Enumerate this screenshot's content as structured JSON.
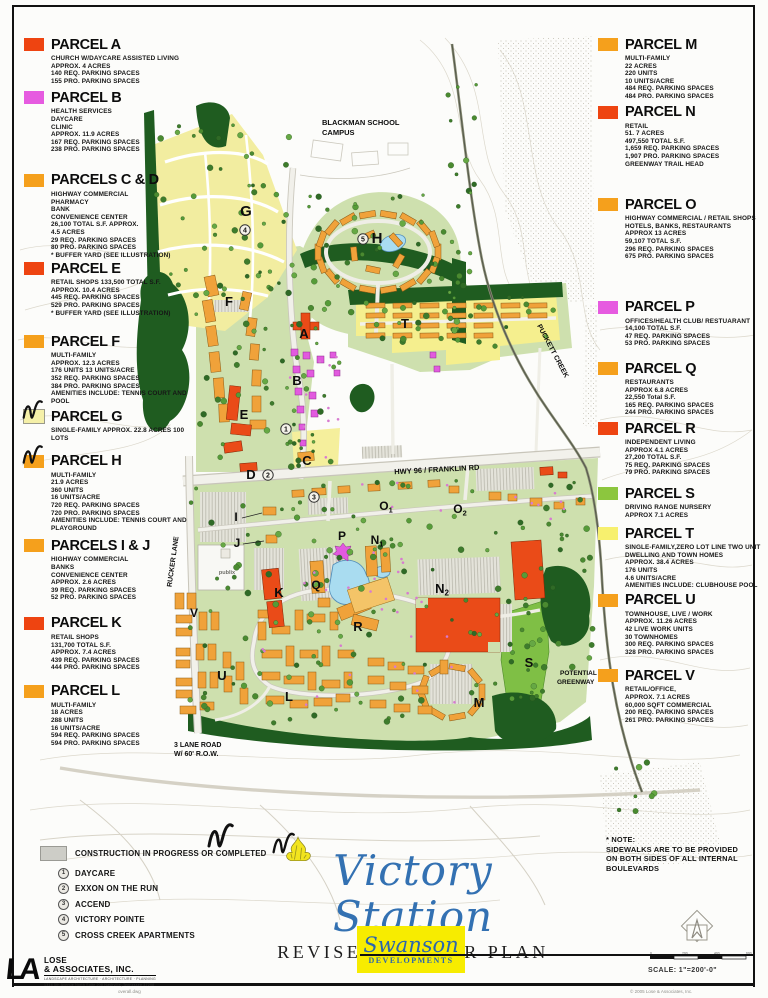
{
  "left_legend": [
    {
      "title": "PARCEL A",
      "swatch": "#EE4411",
      "gap": 4,
      "lines": [
        "CHURCH W/DAYCARE ASSISTED LIVING",
        "APPROX. 4 ACRES",
        "140 REQ. PARKING SPACES",
        "155 PRO. PARKING SPACES"
      ]
    },
    {
      "title": "PARCEL B",
      "swatch": "#E65BE0",
      "gap": 18,
      "lines": [
        "HEALTH SERVICES",
        "DAYCARE",
        "CLINIC",
        "APPROX. 11.9 ACRES",
        "167 REQ. PARKING SPACES",
        "238 PRO. PARKING SPACES"
      ]
    },
    {
      "title": "PARCELS C & D",
      "swatch": "#F5A01C",
      "gap": 1,
      "lines": [
        "HIGHWAY COMMERCIAL",
        "PHARMACY",
        "BANK",
        "CONVENIENCE CENTER",
        "26,100 TOTAL S.F. APPROX.",
        "4.5 ACRES",
        "29 REQ. PARKING SPACES",
        "80 PRO. PARKING SPACES",
        "* BUFFER YARD (SEE ILLUSTRATION)"
      ]
    },
    {
      "title": "PARCEL E",
      "swatch": "#EE4411",
      "gap": 16,
      "lines": [
        "RETAIL SHOPS 133,500 TOTAL S.F.",
        "APPROX. 10.4 ACRES",
        "445 REQ. PARKING SPACES",
        "529 PRO. PARKING SPACES",
        "* BUFFER YARD (SEE ILLUSTRATION)"
      ]
    },
    {
      "title": "PARCEL F",
      "swatch": "#F5A01C",
      "gap": 3,
      "lines": [
        "MULTI-FAMILY",
        "APPROX. 12.3 ACRES",
        "176 UNITS 13 UNITS/ACRE",
        "352 REQ. PARKING SPACES",
        "384 PRO. PARKING SPACES",
        "AMENITIES INCLUDE: TENNIS COURT AND",
        "POOL"
      ]
    },
    {
      "title": "PARCEL G",
      "swatch": "#F5F0A8",
      "check": true,
      "border": true,
      "gap": 10,
      "lines": [
        "SINGLE-FAMILY APPROX. 22.8 ACRES 100",
        "LOTS"
      ]
    },
    {
      "title": "PARCEL H",
      "swatch": "#F5A01C",
      "check": true,
      "gap": 5,
      "lines": [
        "MULTI-FAMILY",
        "21.9 ACRES",
        "360 UNITS",
        "16 UNITS/ACRE",
        "720 REQ. PARKING SPACES",
        "720 PRO. PARKING SPACES",
        "AMENITIES INCLUDE: TENNIS COURT AND",
        "PLAYGROUND"
      ]
    },
    {
      "title": "PARCELS I & J",
      "swatch": "#F5A01C",
      "gap": 13,
      "lines": [
        "HIGHWAY COMMERCIAL",
        "BANKS",
        "CONVENIENCE CENTER",
        "APPROX. 2.6 ACRES",
        "39 REQ. PARKING SPACES",
        "52 PRO. PARKING SPACES"
      ]
    },
    {
      "title": "PARCEL K",
      "swatch": "#EE4411",
      "gap": 11,
      "lines": [
        "RETAIL SHOPS",
        "131,700 TOTAL S.F.",
        "APPROX. 7.4 ACRES",
        "439 REQ. PARKING SPACES",
        "444 PRO. PARKING SPACES"
      ]
    },
    {
      "title": "PARCEL L",
      "swatch": "#F5A01C",
      "gap": 0,
      "lines": [
        "MULTI-FAMILY",
        "18 ACRES",
        "288 UNITS",
        "16 UNITS/ACRE",
        "594 REQ. PARKING SPACES",
        "594 PRO. PARKING SPACES"
      ]
    }
  ],
  "right_legend": [
    {
      "title": "PARCEL M",
      "swatch": "#F5A01C",
      "gap": 3,
      "lines": [
        "MULTI-FAMILY",
        "22 ACRES",
        "220 UNITS",
        "10 UNITS/ACRE",
        "484 REQ. PARKING SPACES",
        "484 PRO. PARKING SPACES"
      ]
    },
    {
      "title": "PARCEL N",
      "swatch": "#EE4411",
      "gap": 28,
      "lines": [
        "RETAIL",
        "51. 7 ACRES",
        "497,550 TOTAL S.F.",
        "1,659  REQ. PARKING SPACES",
        "1,907 PRO. PARKING SPACES",
        "GREENWAY TRAIL HEAD"
      ]
    },
    {
      "title": "PARCEL O",
      "swatch": "#F5A01C",
      "gap": 38,
      "lines": [
        "HIGHWAY COMMERCIAL / RETAIL SHOPS",
        "HOTELS, BANKS, RESTAURANTS",
        "APPROX 13 ACRES",
        "59,107 TOTAL S.F.",
        "296 REQ. PARKING SPACES",
        "675 PRO. PARKING SPACES"
      ]
    },
    {
      "title": "PARCEL P",
      "swatch": "#E65BE0",
      "gap": 12,
      "lines": [
        "OFFICES/HEALTH CLUB/ RESTUARANT",
        "14,100 TOTAL S.F.",
        "47 REQ. PARKING SPACES",
        "53 PRO. PARKING SPACES"
      ]
    },
    {
      "title": "PARCEL Q",
      "swatch": "#F5A01C",
      "gap": 3,
      "lines": [
        "RESTAURANTS",
        "APPROX 6.8 ACRES",
        "22,550 Total S.F.",
        "165 REQ. PARKING SPACES",
        "244 PRO. PARKING SPACES"
      ]
    },
    {
      "title": "PARCEL R",
      "swatch": "#EE4411",
      "gap": 8,
      "lines": [
        "INDEPENDENT LIVING",
        "APPROX 4.1 ACRES",
        "27,200 TOTAL S.F.",
        "75 REQ. PARKING SPACES",
        "79 PRO. PARKING SPACES"
      ]
    },
    {
      "title": "PARCEL S",
      "swatch": "#8CC63E",
      "gap": 6,
      "lines": [
        "DRIVING RANGE  NURSERY",
        "APPROX 7.1 ACRES"
      ]
    },
    {
      "title": "PARCEL T",
      "swatch": "#F7F06E",
      "gap": 2,
      "lines": [
        "SINGLE-FAMILY,ZERO LOT LINE  TWO UNIT",
        "DWELLING AND TOWN HOMES",
        "APPROX. 38.4 ACRES",
        "176 UNITS",
        "4.6 UNITS/ACRE",
        "AMENITIES INCLUDE:  CLUBHOUSE  POOL"
      ]
    },
    {
      "title": "PARCEL U",
      "swatch": "#F5A01C",
      "gap": 11,
      "lines": [
        "TOWNHOUSE, LIVE / WORK",
        "APPROX. 11.26 ACRES",
        "42 LIVE WORK UNITS",
        "30 TOWNHOMES",
        "300 REQ. PARKING SPACES",
        "328 PRO. PARKING SPACES"
      ]
    },
    {
      "title": "PARCEL V",
      "swatch": "#F5A01C",
      "gap": 0,
      "lines": [
        "RETAIL/OFFICE,",
        "APPROX. 7.1 ACRES",
        "60,000 SQFT COMMERCIAL",
        "200 REQ. PARKING SPACES",
        "261 PRO. PARKING SPACES"
      ]
    }
  ],
  "map": {
    "labels": [
      {
        "t": "BLACKMAN SCHOOL",
        "x": 322,
        "y": 125,
        "s": 7.5,
        "a": "start"
      },
      {
        "t": "CAMPUS",
        "x": 322,
        "y": 135,
        "s": 7.5,
        "a": "start"
      },
      {
        "t": "PUCKETT CREEK",
        "x": 551,
        "y": 352,
        "s": 7,
        "r": 62
      },
      {
        "t": "HWY 96 / FRANKLIN RD",
        "x": 437,
        "y": 472,
        "s": 7.5,
        "r": -3
      },
      {
        "t": "RUCKER LANE",
        "x": 175,
        "y": 562,
        "s": 7,
        "r": -82
      },
      {
        "t": "POTENTIAL",
        "x": 560,
        "y": 675,
        "s": 6.5,
        "a": "start"
      },
      {
        "t": "GREENWAY",
        "x": 557,
        "y": 684,
        "s": 6.5,
        "a": "start"
      },
      {
        "t": "3 LANE ROAD",
        "x": 174,
        "y": 747,
        "s": 7,
        "a": "start"
      },
      {
        "t": "W/ 60' R.O.W.",
        "x": 174,
        "y": 756,
        "s": 7,
        "a": "start"
      },
      {
        "t": "publix",
        "x": 227,
        "y": 574,
        "s": 5.5,
        "c": "#6e6e68"
      },
      {
        "t": "G",
        "x": 246,
        "y": 216,
        "s": 15
      },
      {
        "t": "H",
        "x": 377,
        "y": 243,
        "s": 15
      },
      {
        "t": "F",
        "x": 229,
        "y": 306,
        "s": 13
      },
      {
        "t": "A",
        "x": 304,
        "y": 338,
        "s": 13
      },
      {
        "t": "B",
        "x": 297,
        "y": 385,
        "s": 13
      },
      {
        "t": "E",
        "x": 244,
        "y": 419,
        "s": 13
      },
      {
        "t": "C",
        "x": 307,
        "y": 465,
        "s": 13
      },
      {
        "t": "D",
        "x": 251,
        "y": 479,
        "s": 13
      },
      {
        "t": "T",
        "x": 405,
        "y": 328,
        "s": 13
      },
      {
        "t": "I",
        "x": 236,
        "y": 521,
        "s": 12
      },
      {
        "t": "J",
        "x": 237,
        "y": 547,
        "s": 12
      },
      {
        "t": "P",
        "x": 342,
        "y": 540,
        "s": 12
      },
      {
        "t": "Q",
        "x": 316,
        "y": 589,
        "s": 12
      },
      {
        "t": "K",
        "x": 279,
        "y": 597,
        "s": 13
      },
      {
        "t": "R",
        "x": 358,
        "y": 631,
        "s": 13
      },
      {
        "t": "V",
        "x": 194,
        "y": 617,
        "s": 12
      },
      {
        "t": "U",
        "x": 222,
        "y": 680,
        "s": 13
      },
      {
        "t": "L",
        "x": 289,
        "y": 701,
        "s": 13
      },
      {
        "t": "M",
        "x": 479,
        "y": 707,
        "s": 13
      },
      {
        "t": "S",
        "x": 529,
        "y": 667,
        "s": 13
      },
      {
        "t": "N",
        "sub": "1",
        "x": 377,
        "y": 544,
        "s": 12
      },
      {
        "t": "N",
        "sub": "2",
        "x": 442,
        "y": 593,
        "s": 13
      },
      {
        "t": "O",
        "sub": "1",
        "x": 386,
        "y": 510,
        "s": 12
      },
      {
        "t": "O",
        "sub": "2",
        "x": 460,
        "y": 513,
        "s": 12
      }
    ],
    "circled_numbers": [
      {
        "n": "4",
        "x": 245,
        "y": 230
      },
      {
        "n": "5",
        "x": 363,
        "y": 239
      },
      {
        "n": "1",
        "x": 286,
        "y": 429
      },
      {
        "n": "2",
        "x": 268,
        "y": 475
      },
      {
        "n": "3",
        "x": 314,
        "y": 497
      }
    ]
  },
  "construction": {
    "label": "CONSTRUCTION IN PROGRESS OR COMPLETED",
    "items": [
      {
        "n": "1",
        "label": "DAYCARE"
      },
      {
        "n": "2",
        "label": "EXXON ON THE RUN"
      },
      {
        "n": "3",
        "label": "ACCEND"
      },
      {
        "n": "4",
        "label": "VICTORY POINTE"
      },
      {
        "n": "5",
        "label": "CROSS CREEK APARTMENTS"
      }
    ]
  },
  "title_block": {
    "title": "Victory Station",
    "subtitle": "REVISED MASTER PLAN",
    "developer_name": "Swanson",
    "developer_sub": "DEVELOPMENTS"
  },
  "note": {
    "lines": [
      "* NOTE:",
      "SIDEWALKS ARE TO BE PROVIDED",
      "ON BOTH SIDES OF ALL INTERNAL",
      "BOULEVARDS"
    ]
  },
  "scale": {
    "label": "SCALE:  1\"=200'-0\"",
    "ticks": [
      "0",
      "200",
      "400",
      "600"
    ]
  },
  "firm": {
    "la": "LA",
    "name_line1": "LOSE",
    "name_line2": "& ASSOCIATES, INC.",
    "tagline": "LANDSCAPE ARCHITECTURE  ·  ARCHITECTURE  ·  PLANNING",
    "address": "1314 5th Avenue North Suite 200    Nashville, Tennessee    37208"
  },
  "footer": {
    "left": "overall.dwg",
    "right": "© 2005 Lose & Associates, Inc."
  },
  "colors": {
    "accent_red": "#EE4411",
    "accent_orange": "#F5A01C",
    "accent_magenta": "#E65BE0",
    "accent_green": "#8CC63E",
    "accent_yellow": "#F7F06E",
    "title_blue": "#3371B2",
    "logo_yellow": "#F7EC00"
  }
}
